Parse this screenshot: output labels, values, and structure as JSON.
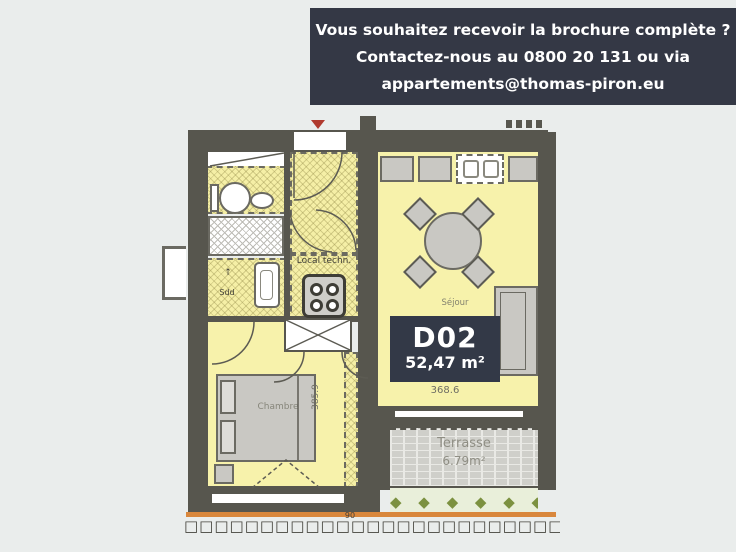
{
  "banner": {
    "line1": "Vous souhaitez recevoir la brochure complète ?",
    "line2": "Contactez-nous au 0800 20 131 ou via",
    "line3": "appartements@thomas-piron.eu"
  },
  "unit": {
    "code": "D02",
    "area": "52,47 m²"
  },
  "rooms": {
    "sejour": "Séjour",
    "chambre": "Chambre",
    "local_techn": "Local techn.",
    "sdd": "Sdd",
    "terrasse": "Terrasse",
    "terrasse_area": "6.79m²"
  },
  "dimensions": {
    "sejour_width": "368.6",
    "chambre_height": "385.9",
    "ground": "90"
  },
  "decor": {
    "sdd_arrow": "↑",
    "plants": "◆ ◆ ◆ ◆ ◆ ◆",
    "ground_squares": "□□□□□□□□□□□□□□□□□□□□□□□□□□□□"
  },
  "colors": {
    "banner_bg": "#343845",
    "badge_bg": "#333947",
    "room_fill": "#f7f2ab",
    "wall": "#57564e",
    "plants_green": "#7c9140",
    "ground_orange": "#d9873c",
    "background": "#eaedec"
  }
}
